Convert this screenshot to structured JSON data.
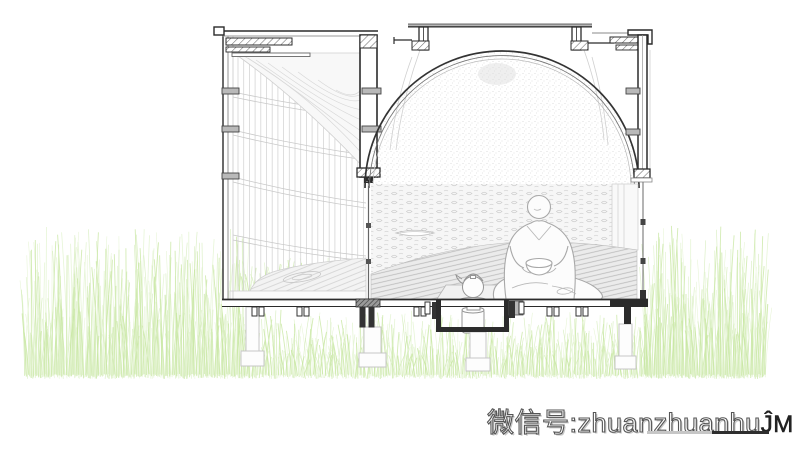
{
  "watermark": {
    "prefix": "微信号:",
    "handle": "zhuanzhuanhu",
    "tail": "ĴM",
    "underline_gray": "#c6c6c6",
    "underline_dark": "#2e2e2e",
    "text_fill": "#ffffff",
    "outline_color": "#555555"
  },
  "palette": {
    "background": "#ffffff",
    "line_dark": "#2b2b2b",
    "line_medium": "#8a8a8a",
    "line_light": "#c8c8c8",
    "metal_tab_fill": "#b9b9b9",
    "grass_greens": [
      "#cbe8a6",
      "#bfe298",
      "#d8efbf",
      "#c3e49a"
    ]
  }
}
